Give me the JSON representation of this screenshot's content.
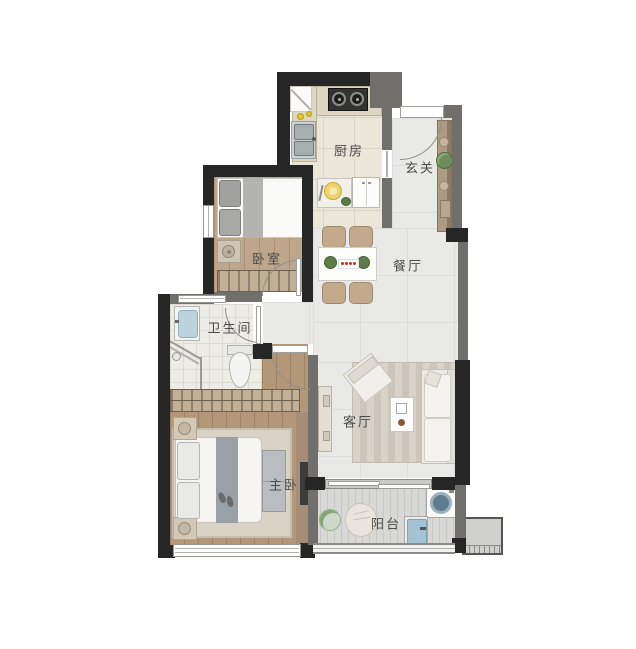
{
  "plan": {
    "type": "residential floor plan, top-down view",
    "rooms": [
      {
        "name": "kitchen",
        "label": "厨房"
      },
      {
        "name": "entry",
        "label": "玄关"
      },
      {
        "name": "bedroom",
        "label": "卧室"
      },
      {
        "name": "dining-room",
        "label": "餐厅"
      },
      {
        "name": "bathroom",
        "label": "卫生间"
      },
      {
        "name": "living-room",
        "label": "客厅"
      },
      {
        "name": "master-bedroom",
        "label": "主卧"
      },
      {
        "name": "balcony",
        "label": "阳台"
      }
    ],
    "colors": {
      "structural_wall": "#262626",
      "partition_wall": "#716f6c",
      "wood_floor": "#b29878",
      "tile_floor": "#e9e9e7",
      "kitchen_floor": "#eae6d8",
      "balcony_floor": "#d8d8d6",
      "wardrobe_stripe": "#c0b096",
      "plant_green": "#6d8d5c",
      "centerpiece_red": "#c03028",
      "water_blue": "#a4c2d4"
    }
  }
}
